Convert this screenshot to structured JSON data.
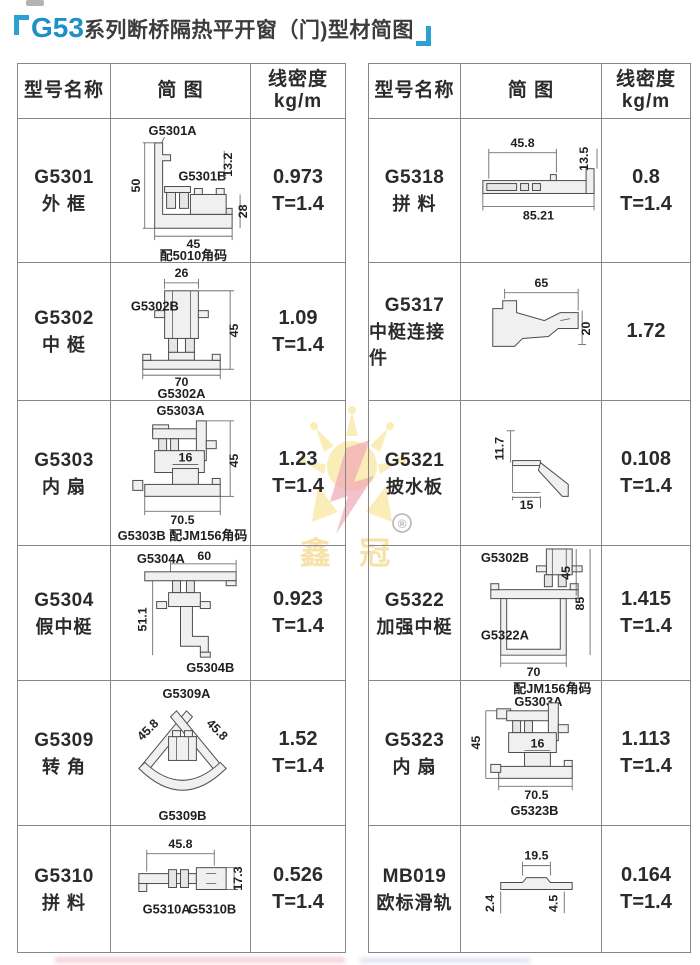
{
  "title": {
    "series": "G53",
    "text": "系列断桥隔热平开窗（门)型材简图"
  },
  "header": {
    "model": "型号名称",
    "diagram": "简 图",
    "density1": "线密度",
    "density2": "kg/m"
  },
  "watermark": {
    "brand": "鑫 冠",
    "reg": "®"
  },
  "left_rows": [
    {
      "model": "G5301",
      "name": "外 框",
      "density": "0.973",
      "t": "T=1.4",
      "d": {
        "labelA": "G5301A",
        "labelB": "G5301B",
        "h": "50",
        "d1": "13.2",
        "d2": "28",
        "w": "45",
        "note": "配5010角码"
      }
    },
    {
      "model": "G5302",
      "name": "中 梃",
      "density": "1.09",
      "t": "T=1.4",
      "d": {
        "labelB": "G5302B",
        "labelA": "G5302A",
        "top": "26",
        "h": "45",
        "w": "70"
      }
    },
    {
      "model": "G5303",
      "name": "内 扇",
      "density": "1.23",
      "t": "T=1.4",
      "d": {
        "labelA": "G5303A",
        "h": "45",
        "inner": "16",
        "w": "70.5",
        "note": "G5303B 配JM156角码"
      }
    },
    {
      "model": "G5304",
      "name": "假中梃",
      "density": "0.923",
      "t": "T=1.4",
      "d": {
        "labelA": "G5304A",
        "labelB": "G5304B",
        "top": "60",
        "h": "51.1"
      }
    },
    {
      "model": "G5309",
      "name": "转 角",
      "density": "1.52",
      "t": "T=1.4",
      "d": {
        "labelA": "G5309A",
        "labelB": "G5309B",
        "dl": "45.8",
        "dr": "45.8"
      }
    },
    {
      "model": "G5310",
      "name": "拼 料",
      "density": "0.526",
      "t": "T=1.4",
      "d": {
        "labelA": "G5310A",
        "labelB": "G5310B",
        "w": "45.8",
        "h": "17.3"
      }
    }
  ],
  "right_rows": [
    {
      "model": "G5318",
      "name": "拼 料",
      "density": "0.8",
      "t": "T=1.4",
      "d": {
        "w1": "45.8",
        "h": "13.5",
        "w2": "85.21"
      }
    },
    {
      "model": "G5317",
      "name": "中梃连接件",
      "density": "1.72",
      "t": "",
      "d": {
        "w": "65",
        "h": "20"
      }
    },
    {
      "model": "G5321",
      "name": "披水板",
      "density": "0.108",
      "t": "T=1.4",
      "d": {
        "h": "11.7",
        "w": "15"
      }
    },
    {
      "model": "G5322",
      "name": "加强中梃",
      "density": "1.415",
      "t": "T=1.4",
      "d": {
        "labelB": "G5302B",
        "labelA": "G5322A",
        "h1": "45",
        "h2": "85",
        "w": "70"
      }
    },
    {
      "model": "G5323",
      "name": "内 扇",
      "density": "1.113",
      "t": "T=1.4",
      "d": {
        "note": "配JM156角码",
        "labelA": "G5303A",
        "h": "45",
        "inner": "16",
        "w": "70.5",
        "labelB": "G5323B"
      }
    },
    {
      "model": "MB019",
      "name": "欧标滑轨",
      "density": "0.164",
      "t": "T=1.4",
      "d": {
        "w": "19.5",
        "hl": "2.4",
        "hr": "4.5"
      }
    }
  ]
}
